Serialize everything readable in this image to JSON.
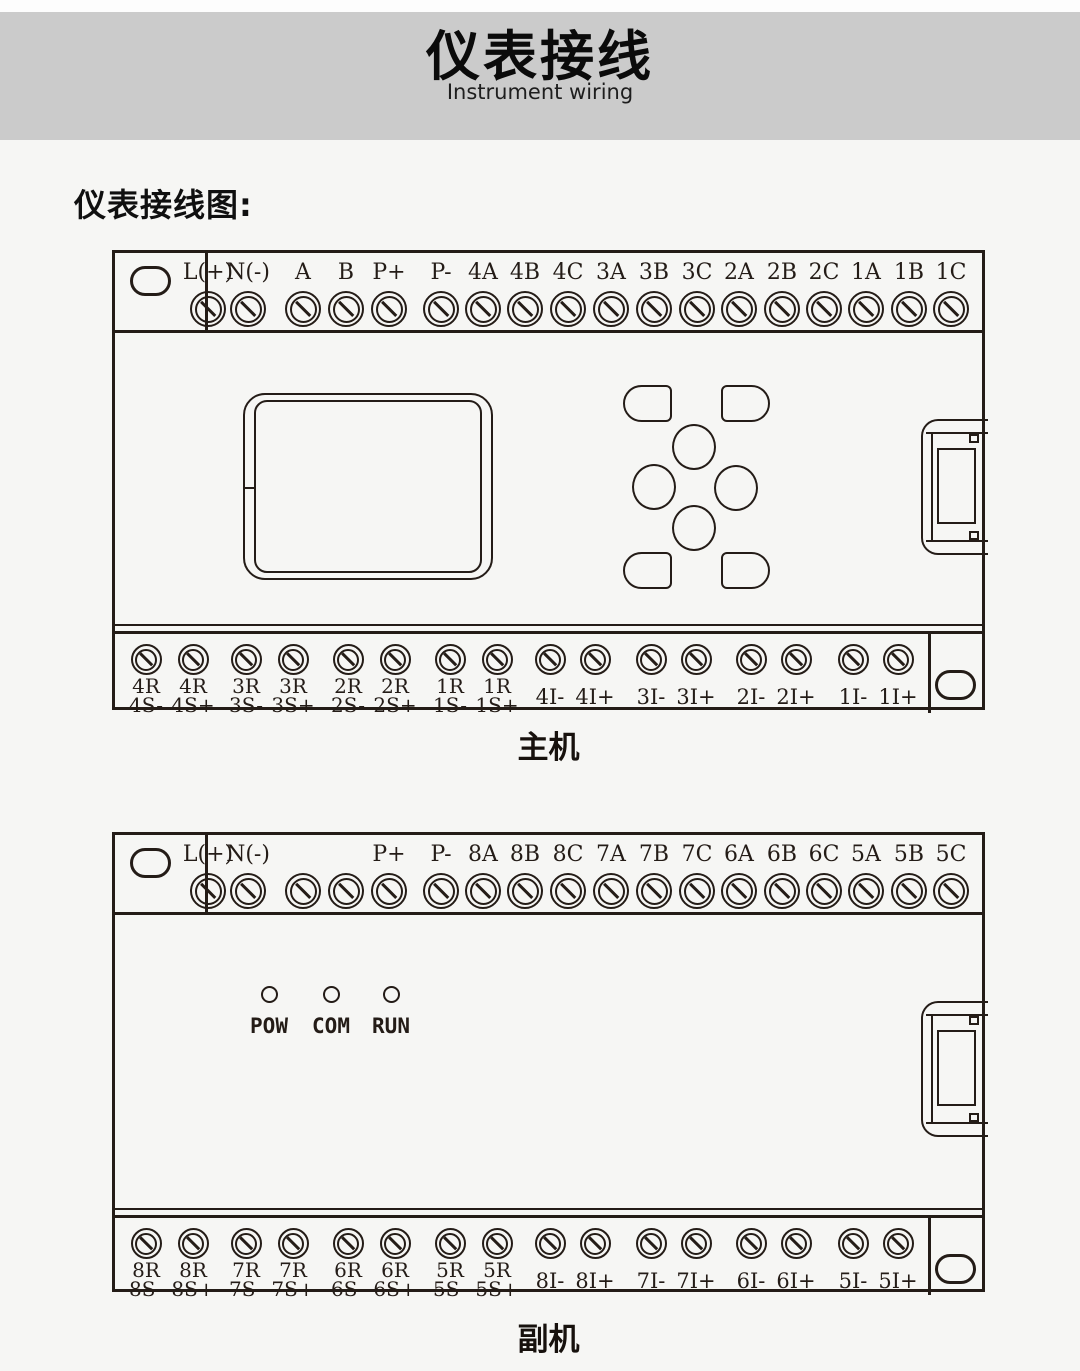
{
  "colors": {
    "banner_bg": "#cbcbcb",
    "page_bg": "#f6f6f4",
    "line_ink": "#241c17"
  },
  "header": {
    "title": "仪表接线",
    "subtitle": "Instrument wiring"
  },
  "section_label": "仪表接线图:",
  "devices": [
    {
      "caption": "主机",
      "top_terminals": [
        "L(+)",
        "N(-)",
        "A",
        "B",
        "P+",
        "P-",
        "4A",
        "4B",
        "4C",
        "3A",
        "3B",
        "3C",
        "2A",
        "2B",
        "2C",
        "1A",
        "1B",
        "1C"
      ],
      "bottom_terminals": [
        {
          "line1": "4R",
          "line2": "4S-"
        },
        {
          "line1": "4R",
          "line2": "4S+"
        },
        {
          "line1": "3R",
          "line2": "3S-"
        },
        {
          "line1": "3R",
          "line2": "3S+"
        },
        {
          "line1": "2R",
          "line2": "2S-"
        },
        {
          "line1": "2R",
          "line2": "2S+"
        },
        {
          "line1": "1R",
          "line2": "1S-"
        },
        {
          "line1": "1R",
          "line2": "1S+"
        },
        {
          "line1": "",
          "line2": "4I-"
        },
        {
          "line1": "",
          "line2": "4I+"
        },
        {
          "line1": "",
          "line2": "3I-"
        },
        {
          "line1": "",
          "line2": "3I+"
        },
        {
          "line1": "",
          "line2": "2I-"
        },
        {
          "line1": "",
          "line2": "2I+"
        },
        {
          "line1": "",
          "line2": "1I-"
        },
        {
          "line1": "",
          "line2": "1I+"
        }
      ],
      "leds": []
    },
    {
      "caption": "副机",
      "top_terminals": [
        "L(+)",
        "N(-)",
        "",
        "",
        "P+",
        "P-",
        "8A",
        "8B",
        "8C",
        "7A",
        "7B",
        "7C",
        "6A",
        "6B",
        "6C",
        "5A",
        "5B",
        "5C"
      ],
      "bottom_terminals": [
        {
          "line1": "8R",
          "line2": "8S-"
        },
        {
          "line1": "8R",
          "line2": "8S+"
        },
        {
          "line1": "7R",
          "line2": "7S-"
        },
        {
          "line1": "7R",
          "line2": "7S+"
        },
        {
          "line1": "6R",
          "line2": "6S-"
        },
        {
          "line1": "6R",
          "line2": "6S+"
        },
        {
          "line1": "5R",
          "line2": "5S-"
        },
        {
          "line1": "5R",
          "line2": "5S+"
        },
        {
          "line1": "",
          "line2": "8I-"
        },
        {
          "line1": "",
          "line2": "8I+"
        },
        {
          "line1": "",
          "line2": "7I-"
        },
        {
          "line1": "",
          "line2": "7I+"
        },
        {
          "line1": "",
          "line2": "6I-"
        },
        {
          "line1": "",
          "line2": "6I+"
        },
        {
          "line1": "",
          "line2": "5I-"
        },
        {
          "line1": "",
          "line2": "5I+"
        }
      ],
      "leds": [
        "POW",
        "COM",
        "RUN"
      ]
    }
  ]
}
